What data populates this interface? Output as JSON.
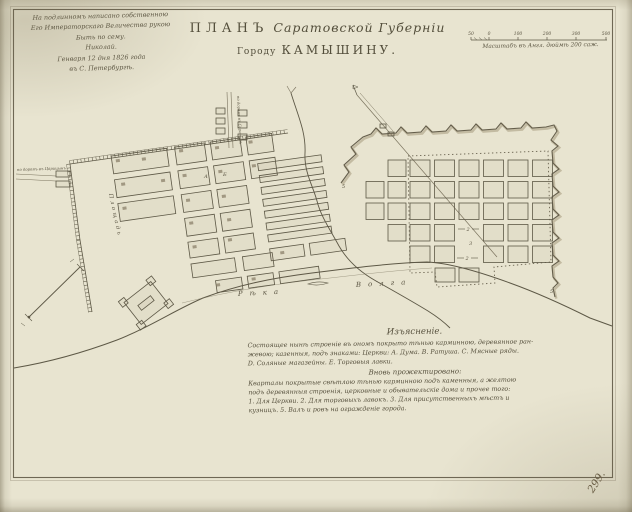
{
  "header": {
    "imprimatur_lines": [
      "На подлинномъ написано собственною",
      "Его Императорскаго Величества рукою",
      "Быть по сему.",
      "Николай.",
      "Генваря 12 дня 1826 года",
      "въ С. Петербургѣ."
    ],
    "title_word": "ПЛАНЪ",
    "title_rest": "Саратовской Губерніи",
    "title_line2_prefix": "Городу",
    "title_line2_city": "КАМЫШИНУ.",
    "scale_caption": "Масштабъ въ Англ. дюймѣ 200 саж.",
    "scale_ticks": [
      "50",
      "0",
      "100",
      "200",
      "300",
      "500"
    ]
  },
  "map": {
    "plaza_label": "Площадь",
    "river_word1": "Рѣка",
    "river_word2": "Волга",
    "road_west_label": "по дорогѣ въ Царицынъ",
    "road_north_label": "по дорогѣ въ Саратовъ",
    "letter_a": "А",
    "letter_b": "Б",
    "num_2a": "2",
    "num_3": "3",
    "num_2b": "2",
    "num_5a": "5",
    "num_5b": "5"
  },
  "explanation": {
    "heading": "Изъясненіе.",
    "para1": [
      "Состоящее нынѣ строеніе въ ономъ покрыто тѣнью карминною, деревянное ран-",
      "жевою; казенныя, подъ знаками: Церкви: А. Дума. В. Ратуша. С. Мясные ряды.",
      "D. Соляные магазейны. Е. Торговыя лавки."
    ],
    "subheading": "Вновь прожектировано:",
    "para2": [
      "Кварталы покрытые свѣтлою тѣнью карминною подъ каменныя, а желтою",
      "подъ деревянныя строенія, церковные и обывательскіе дома и прочее того:",
      "1. Для Церкви. 2. Для торговыхъ лавокъ. 3. Для присутственныхъ мѣстъ и",
      "кузницъ. 5. Валъ и ровъ на огражденіе города."
    ]
  },
  "footer": {
    "page_number": "299."
  },
  "colors": {
    "paper": "#e8e4d0",
    "ink": "#55503e",
    "page_number_ink": "#6a5d45"
  }
}
